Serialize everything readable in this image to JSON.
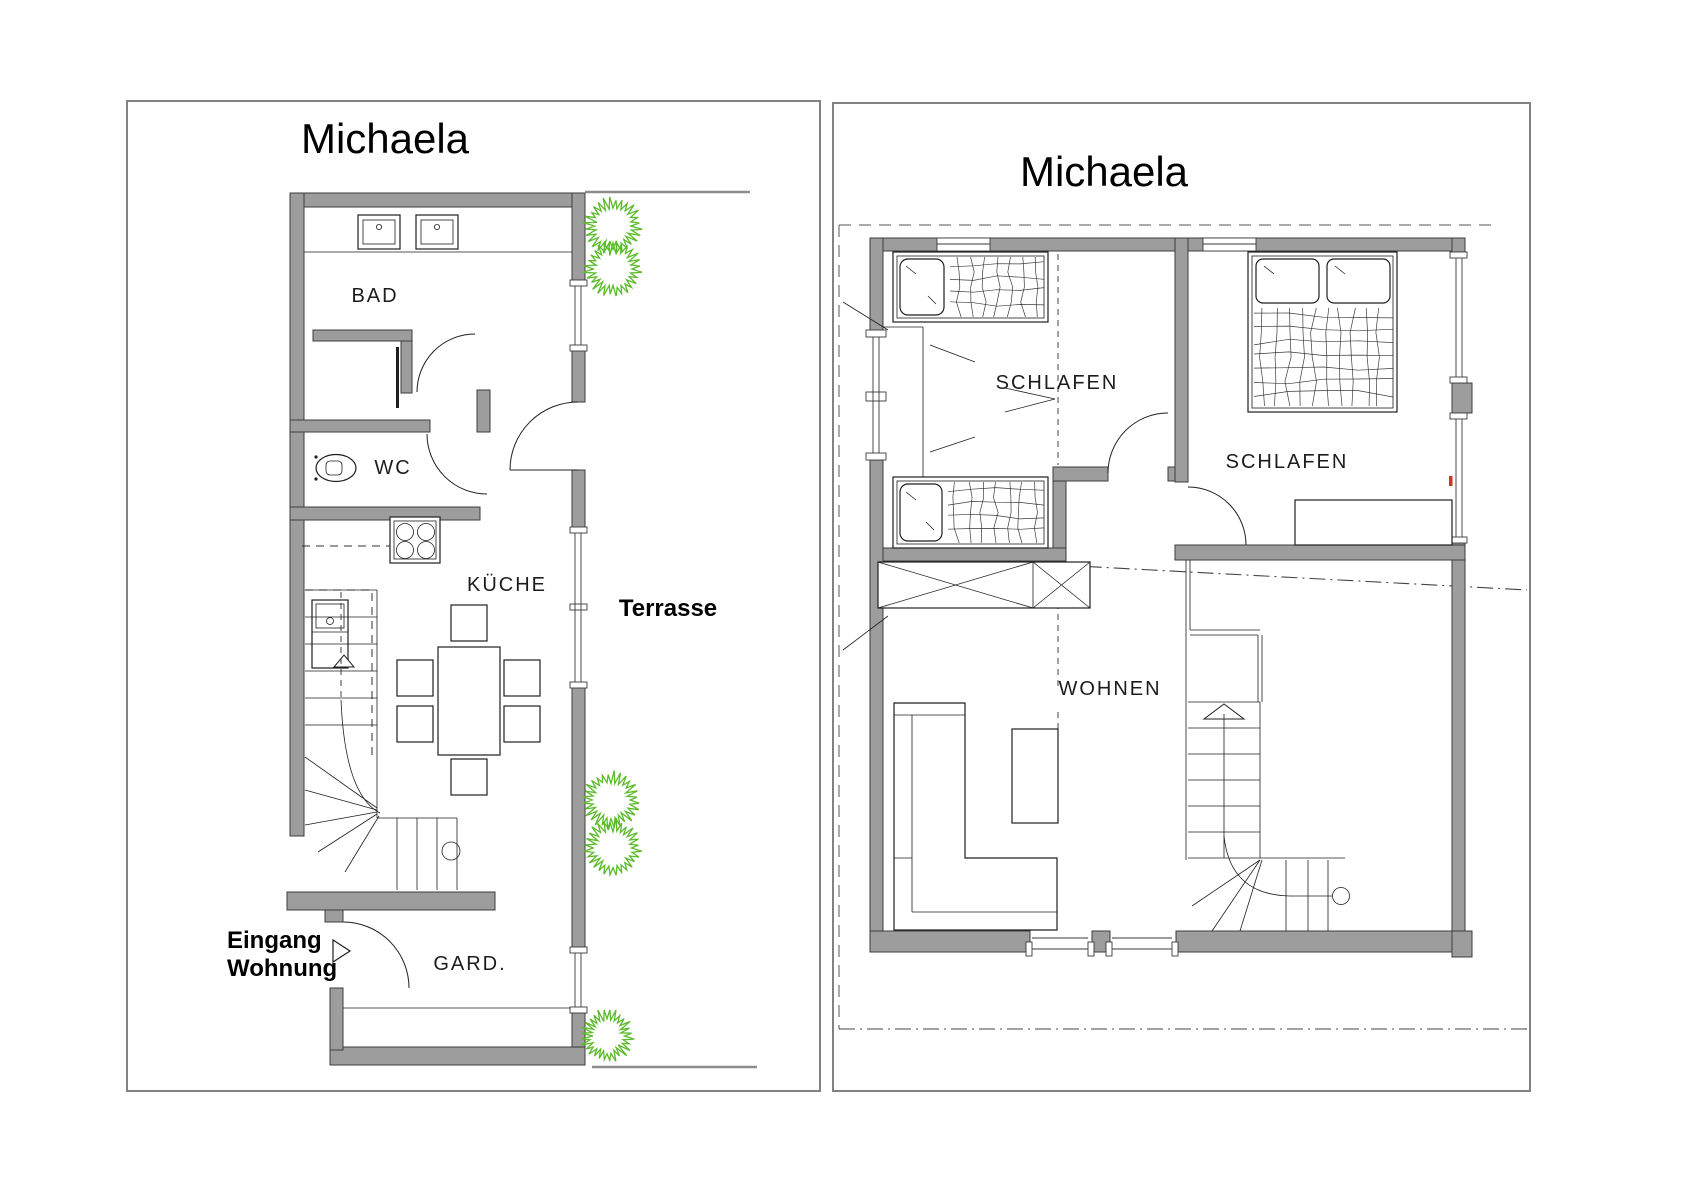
{
  "left_plan": {
    "title": "Michaela",
    "rooms": {
      "bad": "BAD",
      "wc": "WC",
      "kueche": "KÜCHE",
      "gard": "GARD."
    },
    "outside": {
      "terrasse": "Terrasse",
      "entrance_line1": "Eingang",
      "entrance_line2": "Wohnung"
    }
  },
  "right_plan": {
    "title": "Michaela",
    "rooms": {
      "schlafen_left": "SCHLAFEN",
      "schlafen_right": "SCHLAFEN",
      "wohnen": "WOHNEN"
    }
  },
  "colors": {
    "wall": "#9d9d9d",
    "wall_edge": "#3d3d3d",
    "line": "#1f1f1f",
    "frame": "#828282",
    "ground": "#8c8c8c",
    "plant": "#5bbb2a",
    "accent_red": "#c23b22"
  }
}
